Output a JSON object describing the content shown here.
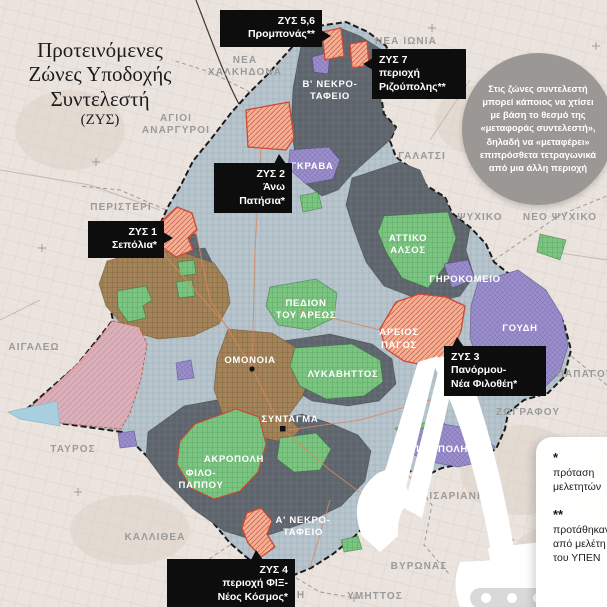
{
  "title": {
    "line1": "Προτεινόμενες",
    "line2": "Ζώνες Υποδοχής",
    "line3": "Συντελεστή",
    "line4": "(ΖΥΣ)"
  },
  "info_circle": {
    "text": "Στις ζώνες συντελεστή μπορεί κάποιος να χτίσει με βάση το θεσμό της «μεταφοράς συντελεστή», δηλαδή να «μεταφέρει» επιπρόσθετα τετραγωνικά από μια άλλη περιοχή"
  },
  "callouts": {
    "zys56": {
      "line1": "ΖΥΣ 5,6",
      "line2": "Προμπονάς**"
    },
    "zys7": {
      "line1": "ΖΥΣ 7",
      "line2": "περιοχή",
      "line3": "Ριζούπολης**"
    },
    "zys2": {
      "line1": "ΖΥΣ 2",
      "line2": "Άνω",
      "line3": "Πατήσια*"
    },
    "zys1": {
      "line1": "ΖΥΣ 1",
      "line2": "Σεπόλια*"
    },
    "zys3": {
      "line1": "ΖΥΣ 3",
      "line2": "Πανόρμου-",
      "line3": "Νέα Φιλοθέη*"
    },
    "zys4": {
      "line1": "ΖΥΣ 4",
      "line2": "περιοχή ΦΙΞ-",
      "line3": "Νέος Κόσμος*"
    }
  },
  "map_labels": {
    "nea_ionia": "ΝΕΑ ΙΩΝΙΑ",
    "nea_chalkidona_1": "ΝΕΑ",
    "nea_chalkidona_2": "ΧΑΛΚΗΔΟΝΑ",
    "agioi_anargyroi_1": "ΑΓΙΟΙ",
    "agioi_anargyroi_2": "ΑΝΑΡΓΥΡΟΙ",
    "galatsi": "ΓΑΛΑΤΣΙ",
    "peristeri": "ΠΕΡΙΣΤΕΡΙ",
    "psychiko": "ΨΥΧΙΚΟ",
    "neo_psychiko": "ΝΕΟ ΨΥΧΙΚΟ",
    "papagou": "ΠΑΠΑΓΟΥ",
    "zografou": "ΖΩΓΡΑΦΟΥ",
    "aigaleo": "ΑΙΓΑΛΕΩ",
    "tavros": "ΤΑΥΡΟΣ",
    "kallithea": "ΚΑΛΛΙΘΕΑ",
    "kaisariani": "ΚΑΙΣΑΡΙΑΝΗ",
    "vyronas": "ΒΥΡΩΝΑΣ",
    "ymittos": "ΥΜΗΤΤΟΣ",
    "dafni": "ΔΑΦΝΗ",
    "b_nekrotafeio_1": "Β' ΝΕΚΡΟ-",
    "b_nekrotafeio_2": "ΤΑΦΕΙΟ",
    "a_nekrotafeio_1": "Α' ΝΕΚΡΟ-",
    "a_nekrotafeio_2": "ΤΑΦΕΙΟ",
    "grava": "ΓΚΡΑΒΑ",
    "attiko_alsos_1": "ΑΤΤΙΚΟ",
    "attiko_alsos_2": "ΑΛΣΟΣ",
    "girokomeio": "ΓΗΡΟΚΟΜΕΙΟ",
    "goudi": "ΓΟΥΔΗ",
    "pedion_1": "ΠΕΔΙΟΝ",
    "pedion_2": "ΤΟΥ ΑΡΕΩΣ",
    "areios_pagos_1": "ΑΡΕΙΟΣ",
    "areios_pagos_2": "ΠΑΓΟΣ",
    "omonoia": "ΟΜΟΝΟΙΑ",
    "lykavittos": "ΛΥΚΑΒΗΤΤΟΣ",
    "syntagma": "ΣΥΝΤΑΓΜΑ",
    "akropoli": "ΑΚΡΟΠΟΛΗ",
    "filopappou_1": "ΦΙΛΟ-",
    "filopappou_2": "ΠΑΠΠΟΥ",
    "panepistimioupoli": "ΠΑΝ/ΠΟΛΗ"
  },
  "footnotes": {
    "star1_symbol": "*",
    "star1_text": "πρόταση μελετητών",
    "star2_symbol": "**",
    "star2_text": "προτάθηκαν από μελέτη του ΥΠΕΝ"
  },
  "colors": {
    "paper": "#ebe4de",
    "city_base": "#b8c5cd",
    "dark_zone": "#5d646b",
    "green_zone": "#7cc482",
    "purple_zone": "#9a8eca",
    "orange_zys_fill": "#f2b096",
    "orange_zys_border": "#c94a32",
    "brown_zone": "#a2835a",
    "pink_zone": "#dbb0ba",
    "water_blue": "#a9cedd",
    "callout_bg": "#0d0d0d",
    "info_circle_bg": "#9a9795",
    "outside_label": "#9a9a9a"
  }
}
